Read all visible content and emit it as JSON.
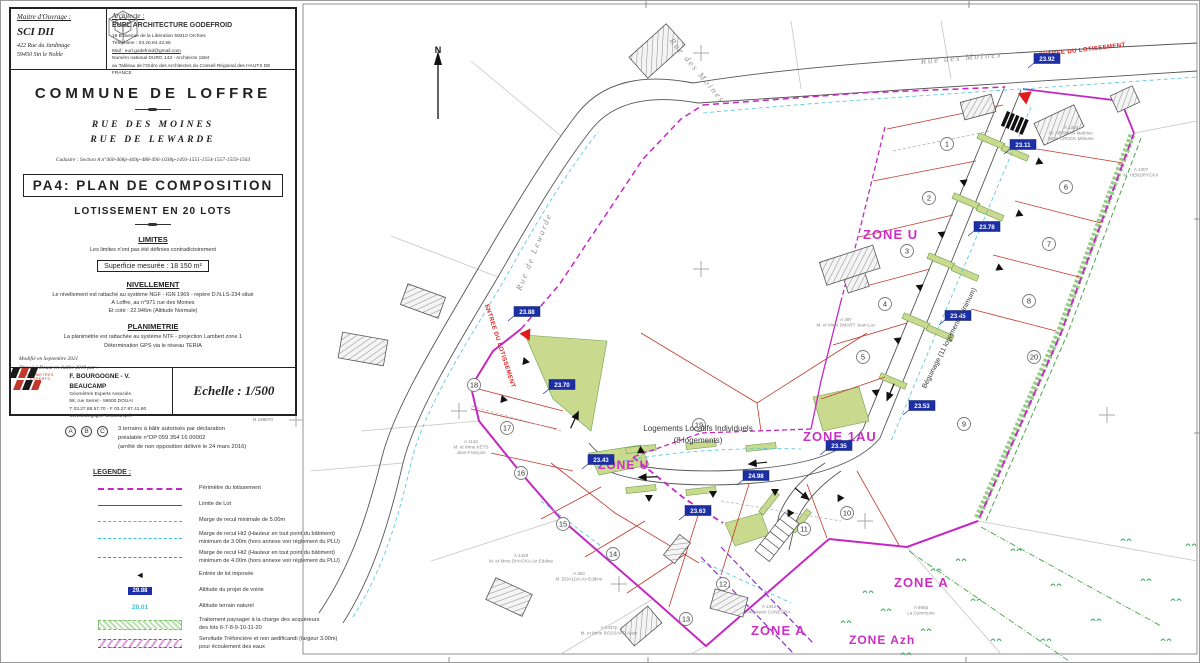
{
  "sheet": {
    "owner_label": "Maitre d'Ouvrage :",
    "owner_name": "SCI DII",
    "owner_addr1": "422 Rue du Jardinage",
    "owner_addr2": "59450  Sin le Noble",
    "architect_label": "Architecte :",
    "architect_name": "EURL ARCHITECTURE GODEFROID",
    "architect_addr": "18 B avenue de la Libération 59310 Orchies",
    "architect_phone": "Téléphone : 03.20.84.42.55",
    "architect_mail": "Mail : eurl.godefroid@gmail.com",
    "architect_note1": "Numéro national DURG 143 - Architecte 1594",
    "architect_note2": "au Tableau de l'Ordre des Architectes du Conseil Régional des HAUTS DE FRANCE",
    "commune": "COMMUNE DE LOFFRE",
    "street1": "RUE DES MOINES",
    "street2": "RUE DE LEWARDE",
    "cadastre": "Cadastre :  Section  A  n°460-468p-469p-488-496-1038p-1493-1551-1554-1557-1559-1563",
    "doc_title": "PA4: PLAN DE COMPOSITION",
    "subtitle": "LOTISSEMENT EN 20 LOTS",
    "limites_title": "LIMITES",
    "limites_text": "Les limites n'ont pas été définies contradictoirement",
    "superficie": "Superficie mesurée : 18 150 m²",
    "niv_title": "NIVELLEMENT",
    "niv1": "Le nivellement est rattaché au système NGF - IGN 1969 - repère D.N.LS-234 situé",
    "niv2": "A Loffre, au n°971 rue des Moines",
    "niv3": "Et coté : 22.946m (Altitude Normale)",
    "plani_title": "PLANIMETRIE",
    "plani1": "La planimétrie est rattachée au système NTF - projection Lambert zone 1",
    "plani2": "Détermination GPS via le réseau TERIA",
    "modif1": "Modifié  en  Septembre 2021",
    "modif2": "Dressé  à  Douai  en  Juillet 2019 par :",
    "surv_name": "F. BOURGOGNE - V. BEAUCAMP",
    "surv_role": "Géomètres Experts Associés",
    "surv_addr": "58, rue Serret - 59500 DOUAI",
    "surv_tel": "T 03.27.88.57.70  -  F 03.27.87.41.90",
    "surv_web": "www.bourgogne-beaucamp.fr",
    "surv_logo_caption": "GEOMETRES EXPERTS",
    "scale": "Echelle : 1/500"
  },
  "note_abc": {
    "badges": [
      "A",
      "B",
      "C"
    ],
    "lines": [
      "3 terrains à bâtir autorisés par déclaration",
      "préalable n°DP 059 354 16 00002",
      "(arrêté de non opposition délivré le 24 mars 2016)"
    ]
  },
  "legend": {
    "title": "LEGENDE :",
    "items": [
      {
        "kind": "perimeter",
        "text": "Périmètre du lotissement"
      },
      {
        "kind": "lotline",
        "text": "Limite de Lot"
      },
      {
        "kind": "gray5",
        "text": "Marge de recul minimale de 5.00m"
      },
      {
        "kind": "cyan3",
        "text": "Marge de recul Ht2 (Hauteur en tout point du bâtiment)\nminimum de 3.00m (hors annexe voir règlement du PLU)"
      },
      {
        "kind": "green4",
        "text": "Marge de recul Ht2 (Hauteur en tout point du bâtiment)\nminimum de 4.00m (hors annexe voir règlement du PLU)"
      },
      {
        "kind": "triangle",
        "text": "Entrée de lot imposée"
      },
      {
        "kind": "altbox",
        "value": "29.88",
        "text": "Altitude du projet de voirie"
      },
      {
        "kind": "altnat",
        "value": "28.01",
        "text": "Altitude terrain naturel"
      },
      {
        "kind": "ghatch",
        "text": "Traitement paysager à la charge des acquéreurs\ndes lots 6-7-8-9-10-11-20"
      },
      {
        "kind": "mhatch",
        "text": "Servitude Tréfoncière et non aedificandi (largeur 3.00m)\npour écoulement des eaux"
      }
    ]
  },
  "plan": {
    "north_label": "N",
    "corner_label": "N 196670",
    "watermark": "entreProp",
    "zones": [
      {
        "label": "ZONE U",
        "x": 862,
        "y": 238,
        "size": 13
      },
      {
        "label": "ZONE 1AU",
        "x": 802,
        "y": 440,
        "size": 13
      },
      {
        "label": "ZONE U",
        "x": 597,
        "y": 468,
        "size": 12
      },
      {
        "label": "ZONE A",
        "x": 893,
        "y": 586,
        "size": 13
      },
      {
        "label": "ZONE A",
        "x": 750,
        "y": 634,
        "size": 13
      },
      {
        "label": "ZONE Azh",
        "x": 848,
        "y": 643,
        "size": 12
      }
    ],
    "streets": [
      {
        "label": "Rue  des  Moines",
        "x": 668,
        "y": 40,
        "rot": 50
      },
      {
        "label": "Rue  des  Moines",
        "x": 920,
        "y": 63,
        "rot": -5
      },
      {
        "label": "Rue  de  Lewarde",
        "x": 520,
        "y": 290,
        "rot": -68
      }
    ],
    "entrance_labels": [
      {
        "label": "ENTREE DU LOTISSEMENT",
        "x": 1038,
        "y": 56,
        "rot": -7
      },
      {
        "label": "ENTREE DU LOTISSEMENT",
        "x": 484,
        "y": 304,
        "rot": 72
      }
    ],
    "altitudes": [
      {
        "v": "23.92",
        "x": 1046,
        "y": 60
      },
      {
        "v": "23.11",
        "x": 1022,
        "y": 146
      },
      {
        "v": "23.78",
        "x": 986,
        "y": 228
      },
      {
        "v": "23.45",
        "x": 957,
        "y": 317
      },
      {
        "v": "23.53",
        "x": 921,
        "y": 407
      },
      {
        "v": "23.35",
        "x": 838,
        "y": 447
      },
      {
        "v": "24.98",
        "x": 755,
        "y": 477
      },
      {
        "v": "23.43",
        "x": 600,
        "y": 461
      },
      {
        "v": "23.63",
        "x": 697,
        "y": 512
      },
      {
        "v": "23.88",
        "x": 526,
        "y": 313
      },
      {
        "v": "23.70",
        "x": 561,
        "y": 386
      }
    ],
    "lots": [
      {
        "n": "1",
        "x": 946,
        "y": 143
      },
      {
        "n": "2",
        "x": 928,
        "y": 197
      },
      {
        "n": "3",
        "x": 906,
        "y": 250
      },
      {
        "n": "4",
        "x": 884,
        "y": 303
      },
      {
        "n": "5",
        "x": 862,
        "y": 356
      },
      {
        "n": "6",
        "x": 1065,
        "y": 186
      },
      {
        "n": "7",
        "x": 1048,
        "y": 243
      },
      {
        "n": "8",
        "x": 1028,
        "y": 300
      },
      {
        "n": "9",
        "x": 963,
        "y": 423
      },
      {
        "n": "10",
        "x": 846,
        "y": 512
      },
      {
        "n": "11",
        "x": 803,
        "y": 528
      },
      {
        "n": "12",
        "x": 722,
        "y": 583
      },
      {
        "n": "13",
        "x": 685,
        "y": 618
      },
      {
        "n": "14",
        "x": 612,
        "y": 553
      },
      {
        "n": "15",
        "x": 562,
        "y": 523
      },
      {
        "n": "16",
        "x": 520,
        "y": 472
      },
      {
        "n": "17",
        "x": 506,
        "y": 427
      },
      {
        "n": "18",
        "x": 473,
        "y": 384
      },
      {
        "n": "19",
        "x": 698,
        "y": 424
      },
      {
        "n": "20",
        "x": 1033,
        "y": 356
      }
    ],
    "parcels": [
      {
        "lines": [
          "A 1303",
          "M. HERMAN Mathieu",
          "Mme CROCK Mélanie"
        ],
        "x": 1070,
        "y": 128
      },
      {
        "lines": [
          "A 1307",
          "M. HENDRYCKX"
        ],
        "x": 1140,
        "y": 170
      },
      {
        "lines": [
          "A 497",
          "M. et Mme SMART Jean-Luc"
        ],
        "x": 845,
        "y": 320
      },
      {
        "lines": [
          "A 1142",
          "M. et Mme KETS",
          "Jean-François"
        ],
        "x": 470,
        "y": 442
      },
      {
        "lines": [
          "A 1429",
          "M. et Mme DHACKA Az-Eddine"
        ],
        "x": 520,
        "y": 556
      },
      {
        "lines": [
          "A 463",
          "M. DDALDA Az-Eddine"
        ],
        "x": 578,
        "y": 574
      },
      {
        "lines": [
          "A 1337p",
          "M. et Mme BOSSARD Alain"
        ],
        "x": 608,
        "y": 628
      },
      {
        "lines": [
          "A 1342",
          "Indivision CANEGRA"
        ],
        "x": 768,
        "y": 607
      },
      {
        "lines": [
          "A 968p",
          "La Commune"
        ],
        "x": 920,
        "y": 608
      }
    ],
    "notes": [
      {
        "label": "Logements Locatifs Individuels",
        "x": 697,
        "y": 430,
        "size": 8
      },
      {
        "label": "(8 logements)",
        "x": 697,
        "y": 442,
        "size": 8
      },
      {
        "label": "Béguinage (11 logements minimum)",
        "x": 950,
        "y": 338,
        "rot": -63,
        "size": 7
      }
    ],
    "veg": [
      [
        1010,
        550
      ],
      [
        1050,
        585
      ],
      [
        970,
        600
      ],
      [
        920,
        630
      ],
      [
        1090,
        620
      ],
      [
        1140,
        580
      ],
      [
        1160,
        640
      ],
      [
        880,
        610
      ],
      [
        840,
        622
      ],
      [
        1120,
        540
      ],
      [
        990,
        640
      ],
      [
        930,
        570
      ],
      [
        862,
        592
      ],
      [
        1170,
        600
      ],
      [
        1040,
        640
      ],
      [
        900,
        654
      ],
      [
        1185,
        545
      ],
      [
        955,
        560
      ]
    ]
  }
}
